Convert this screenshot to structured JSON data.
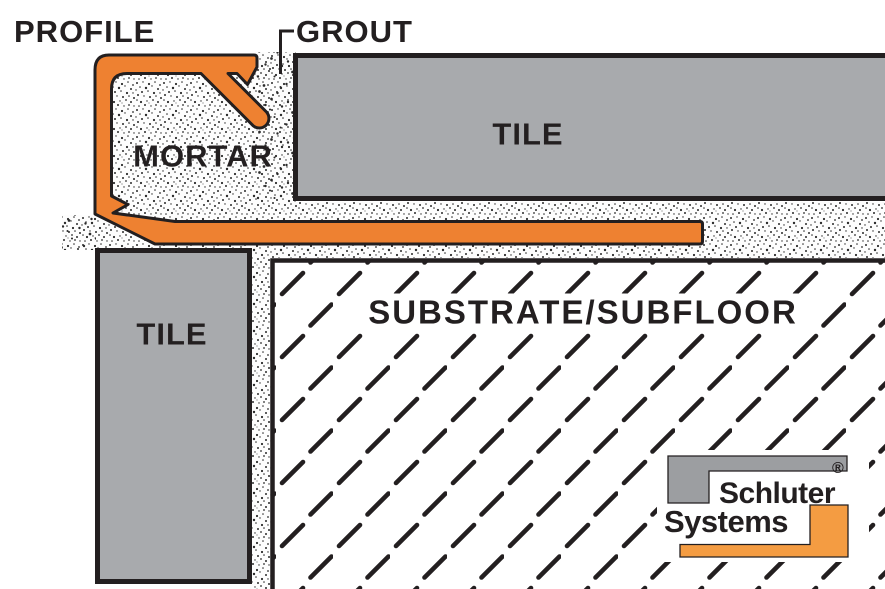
{
  "diagram": {
    "labels": {
      "profile": "PROFILE",
      "grout": "GROUT",
      "mortar": "MORTAR",
      "tile_top": "TILE",
      "tile_left": "TILE",
      "substrate": "SUBSTRATE/SUBFLOOR"
    },
    "logo": {
      "line1": "Schluter",
      "line2": "Systems",
      "registered_mark": "®"
    },
    "colors": {
      "profile_orange": "#EE8131",
      "tile_gray": "#A8AAAD",
      "outline_black": "#231F20",
      "substrate_white": "#FFFFFF",
      "logo_gray": "#9C9EA1",
      "logo_orange": "#F49C42",
      "background": "#FFFFFF"
    }
  }
}
